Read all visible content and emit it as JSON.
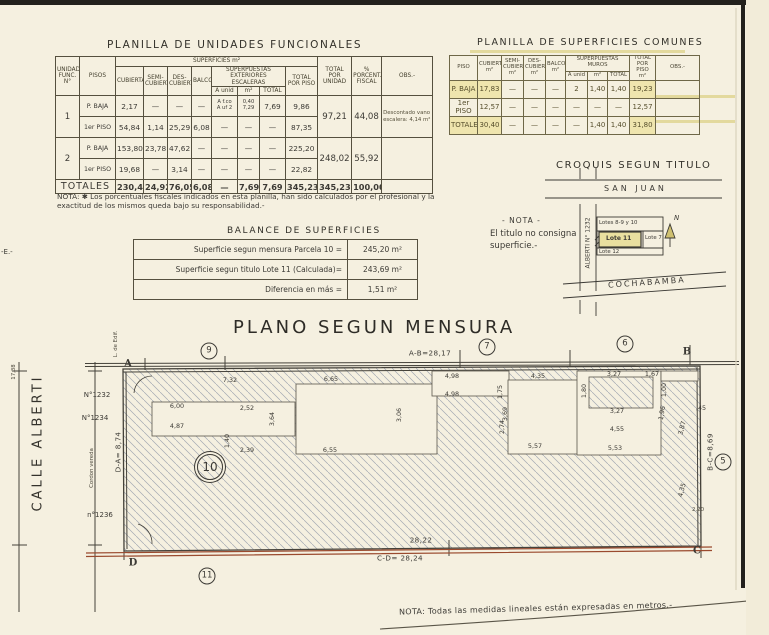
{
  "colors": {
    "paper": "#f5f0e0",
    "ink": "#3c3a35",
    "boundary_red": "#9a4a2e",
    "highlight_yellow": "#efe5ae"
  },
  "unidades": {
    "title": "PLANILLA  DE  UNIDADES  FUNCIONALES",
    "h": {
      "unidad": "UNIDAD\nFUNC.\nN°",
      "pisos": "PISOS",
      "superficies": "SUPERFICIES  m²",
      "cubierta": "CUBIERTA",
      "semi": "SEMI-\nCUBIERTA",
      "des": "DES-\nCUBIERTA",
      "balcon": "BALCON",
      "escaleras": "SUPERPUESTAS\nEXTERIORES\nESCALERAS",
      "a_unid": "A unid",
      "m2": "m²",
      "total": "TOTAL",
      "total_piso": "TOTAL\nPOR PISO",
      "total_unidad": "TOTAL\nPOR UNIDAD",
      "porcent": "%\nPORCENT.\nFISCAL",
      "obs": "OBS.-"
    },
    "rows": [
      [
        {
          "t": "1",
          "rs": 2,
          "cl": "big"
        },
        {
          "t": "P. BAJA",
          "cl": "piso"
        },
        "2,17",
        "—",
        "—",
        "—",
        {
          "t": "A f.co\nA uf 2",
          "cl": "esc"
        },
        {
          "t": "0,40\n7,29",
          "cl": "esc"
        },
        "7,69",
        "9,86",
        {
          "t": "97,21",
          "rs": 2,
          "cl": "big"
        },
        {
          "t": "44,08",
          "rs": 2,
          "cl": "big"
        },
        {
          "t": "Descontado vano escalera: 4,14 m²",
          "rs": 2,
          "cl": "obs"
        }
      ],
      [
        {
          "t": "1er PISO",
          "cl": "piso"
        },
        "54,84",
        "1,14",
        "25,29",
        "6,08",
        "—",
        "—",
        "—",
        "87,35"
      ],
      [
        {
          "t": "2",
          "rs": 2,
          "cl": "big"
        },
        {
          "t": "P. BAJA",
          "cl": "piso"
        },
        "153,80",
        "23,78",
        "47,62",
        "—",
        "—",
        "—",
        "—",
        "225,20",
        {
          "t": "248,02",
          "rs": 2,
          "cl": "big"
        },
        {
          "t": "55,92",
          "rs": 2,
          "cl": "big"
        },
        {
          "t": "",
          "rs": 2,
          "cl": "obs"
        }
      ],
      [
        {
          "t": "1er PISO",
          "cl": "piso"
        },
        "19,68",
        "—",
        "3,14",
        "—",
        "—",
        "—",
        "—",
        "22,82"
      ],
      [
        {
          "t": "TOTALES",
          "cs": 2,
          "cl": "totlbl"
        },
        {
          "t": "230,49",
          "cl": "tot"
        },
        {
          "t": "24,92",
          "cl": "tot"
        },
        {
          "t": "76,05",
          "cl": "tot"
        },
        {
          "t": "6,08",
          "cl": "tot"
        },
        {
          "t": "—",
          "cl": "tot"
        },
        {
          "t": "7,69",
          "cl": "tot"
        },
        {
          "t": "7,69",
          "cl": "tot"
        },
        {
          "t": "345,23",
          "cl": "tot"
        },
        {
          "t": "345,23",
          "cl": "tot"
        },
        {
          "t": "100,00",
          "cl": "tot"
        },
        {
          "t": "",
          "cl": "tot"
        }
      ]
    ],
    "note": "NOTA: ✱ Los porcentuales fiscales indicados en esta planilla, han sido calculados por el profesional y la exactitud de los mismos queda bajo su responsabilidad.-"
  },
  "comunes": {
    "title": "PLANILLA DE SUPERFICIES COMUNES",
    "h": {
      "piso": "PISO",
      "cubierta": "CUBIERTA\nm²",
      "semi": "SEMI-\nCUBIERTA\nm²",
      "des": "DES-\nCUBIERTA\nm²",
      "balcon": "BALCON\nm²",
      "muros": "SUPERPUESTAS\nMUROS",
      "a_unid": "A unid",
      "m2": "m²",
      "total": "TOTAL",
      "total_piso": "TOTAL\nPOR PISO\nm²",
      "obs": "OBS.-"
    },
    "rows": [
      [
        {
          "t": "P. BAJA",
          "cl": "hl"
        },
        {
          "t": "17,83",
          "cl": "hl"
        },
        "—",
        "—",
        "—",
        "2",
        "1,40",
        "1,40",
        {
          "t": "19,23",
          "cl": "hl"
        },
        ""
      ],
      [
        "1er PISO",
        "12,57",
        "—",
        "—",
        "—",
        "—",
        "—",
        "—",
        "12,57",
        ""
      ],
      [
        {
          "t": "TOTALES",
          "cl": "hl"
        },
        {
          "t": "30,40",
          "cl": "hl"
        },
        "—",
        "—",
        "—",
        "—",
        "1,40",
        "1,40",
        {
          "t": "31,80",
          "cl": "hl"
        },
        ""
      ]
    ]
  },
  "balance": {
    "title": "BALANCE  DE  SUPERFICIES",
    "rows": [
      [
        "Superficie segun mensura Parcela 10 =",
        "245,20 m²"
      ],
      [
        "Superficie segun titulo Lote 11 (Calculada)=",
        "243,69 m²"
      ],
      [
        "Diferencia en más   =",
        "1,51 m²"
      ]
    ]
  },
  "croquis": {
    "title": "CROQUIS SEGUN TITULO",
    "street_top": "SAN  JUAN",
    "street_left": "ALBERTI  N° 1232",
    "street_bottom": "COCHABAMBA",
    "note1": "- NOTA -",
    "note2": "El titulo no consigna",
    "note3": "superficie.-",
    "lots": {
      "top": "Lotes 8-9 y 10",
      "main": "Lote 11",
      "right": "Lote 7",
      "bottom": "Lote 12"
    },
    "north": "N"
  },
  "plano": {
    "title": "PLANO  SEGUN  MENSURA",
    "note": "NOTA: Todas las medidas lineales están expresadas en metros.-",
    "circles": [
      {
        "n": "9",
        "x": 209,
        "y": 351
      },
      {
        "n": "7",
        "x": 487,
        "y": 347
      },
      {
        "n": "6",
        "x": 625,
        "y": 344
      },
      {
        "n": "5",
        "x": 723,
        "y": 462
      },
      {
        "n": "10",
        "x": 210,
        "y": 467,
        "big": 1
      },
      {
        "n": "11",
        "x": 207,
        "y": 576
      }
    ],
    "labels": [
      {
        "t": "A",
        "x": 128,
        "y": 364,
        "cls": "corner"
      },
      {
        "t": "B",
        "x": 687,
        "y": 352,
        "cls": "corner"
      },
      {
        "t": "C",
        "x": 697,
        "y": 551,
        "cls": "corner"
      },
      {
        "t": "D",
        "x": 133,
        "y": 563,
        "cls": "corner"
      },
      {
        "t": "A-B=28,17",
        "x": 430,
        "y": 353,
        "cls": "dimb"
      },
      {
        "t": "B-C=8,69",
        "x": 710,
        "y": 452,
        "r": -90,
        "cls": "dimb"
      },
      {
        "t": "C-D= 28,24",
        "x": 400,
        "y": 558,
        "cls": "dimb"
      },
      {
        "t": "D-A= 8,74",
        "x": 118,
        "y": 452,
        "r": -90,
        "cls": "dimb"
      },
      {
        "t": "28,22",
        "x": 421,
        "y": 540,
        "cls": "dimb"
      },
      {
        "t": "CALLE  ALBERTI",
        "x": 38,
        "y": 443,
        "r": -90,
        "cls": "street"
      },
      {
        "t": "Cordon vereda",
        "x": 92,
        "y": 468,
        "r": -90,
        "cls": "tiny"
      },
      {
        "t": "L. de Edif.",
        "x": 116,
        "y": 344,
        "r": -90,
        "cls": "tiny"
      },
      {
        "t": "17,38",
        "x": 14,
        "y": 372,
        "r": -90,
        "cls": "tiny"
      },
      {
        "t": "N°1232",
        "x": 97,
        "y": 395,
        "cls": "small"
      },
      {
        "t": "N°1234",
        "x": 95,
        "y": 418,
        "cls": "small"
      },
      {
        "t": "n°1236",
        "x": 100,
        "y": 515,
        "cls": "small"
      },
      {
        "t": "7,32",
        "x": 230,
        "y": 380
      },
      {
        "t": "6,65",
        "x": 331,
        "y": 379
      },
      {
        "t": "4,98",
        "x": 452,
        "y": 376
      },
      {
        "t": "4,35",
        "x": 538,
        "y": 376
      },
      {
        "t": "3,27",
        "x": 614,
        "y": 374
      },
      {
        "t": "1,67",
        "x": 652,
        "y": 374
      },
      {
        "t": "1,00",
        "x": 664,
        "y": 390,
        "r": -90
      },
      {
        "t": "1,80",
        "x": 584,
        "y": 391,
        "r": -90
      },
      {
        "t": "6,00",
        "x": 177,
        "y": 406
      },
      {
        "t": "2,52",
        "x": 247,
        "y": 408
      },
      {
        "t": "3,64",
        "x": 272,
        "y": 419,
        "r": -90
      },
      {
        "t": "4,87",
        "x": 177,
        "y": 426
      },
      {
        "t": "4,98",
        "x": 452,
        "y": 394
      },
      {
        "t": "1,75",
        "x": 500,
        "y": 392,
        "r": -90
      },
      {
        "t": "1,40",
        "x": 227,
        "y": 441,
        "r": -90
      },
      {
        "t": "2,39",
        "x": 247,
        "y": 450
      },
      {
        "t": "6,55",
        "x": 330,
        "y": 450
      },
      {
        "t": "3,06",
        "x": 399,
        "y": 415,
        "r": -90
      },
      {
        "t": "3,69",
        "x": 505,
        "y": 414,
        "r": -90
      },
      {
        "t": "2,74",
        "x": 502,
        "y": 427,
        "r": -90
      },
      {
        "t": "3,27",
        "x": 617,
        "y": 411
      },
      {
        "t": "4,55",
        "x": 617,
        "y": 429
      },
      {
        "t": "5,53",
        "x": 615,
        "y": 448
      },
      {
        "t": "5,57",
        "x": 535,
        "y": 446
      },
      {
        "t": "1,96",
        "x": 662,
        "y": 413,
        "r": -80
      },
      {
        "t": "3,87",
        "x": 682,
        "y": 428,
        "r": -75
      },
      {
        "t": ",45",
        "x": 701,
        "y": 408
      },
      {
        "t": "4,35",
        "x": 682,
        "y": 490,
        "r": -75
      },
      {
        "t": "2,20",
        "x": 698,
        "y": 510,
        "cls": "tiny"
      }
    ]
  },
  "misc": {
    "edge_label": "-E.-"
  }
}
